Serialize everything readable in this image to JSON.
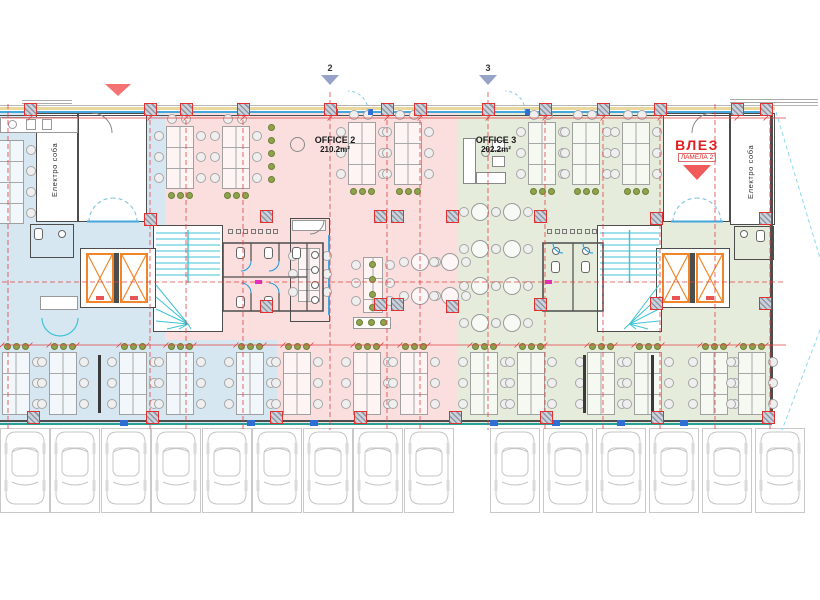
{
  "labels": {
    "office2": {
      "name": "OFFICE 2",
      "area": "210.2m²"
    },
    "office3": {
      "name": "OFFICE 3",
      "area": "202.2m²"
    },
    "entrance": {
      "title": "ВЛЕЗ",
      "subtitle": "ЛАМЕЛА 2"
    },
    "electro_left": "Електро соба",
    "electro_right": "Електро соба",
    "section2": "2",
    "section3": "3"
  },
  "colors": {
    "zone_blue": "#d7e7f1",
    "zone_pink": "#fbdfdf",
    "zone_green": "#e5ecdb",
    "grid_red": "#e04343",
    "wall": "#4d4d4d",
    "glass_blue": "#45a5dd",
    "facade_tan": "#e8d79e",
    "bottom_teal": "#2aa198",
    "stair_cyan": "#3ec3d4",
    "elevator_orange": "#f0862c",
    "plant_green": "#8fa24d",
    "car_gray": "#c6c6c6",
    "entrance_red": "#e02020",
    "marker_blue": "#97a3c6",
    "window_tick_blue": "#2f6fd4",
    "door_blue": "#7fc4e8",
    "magenta_tag": "#e22ecc"
  },
  "floor": {
    "zones": [
      {
        "color": "blue",
        "x": 0,
        "y": 112,
        "w": 165,
        "h": 228
      },
      {
        "color": "pink",
        "x": 165,
        "y": 112,
        "w": 293,
        "h": 228
      },
      {
        "color": "green",
        "x": 458,
        "y": 112,
        "w": 314,
        "h": 228
      },
      {
        "color": "blue",
        "x": 0,
        "y": 340,
        "w": 277,
        "h": 83
      },
      {
        "color": "pink",
        "x": 277,
        "y": 340,
        "w": 181,
        "h": 83
      },
      {
        "color": "green",
        "x": 458,
        "y": 340,
        "w": 314,
        "h": 83
      }
    ],
    "rooms": [
      {
        "name": "electro-room-left",
        "x": 36,
        "y": 113,
        "w": 42,
        "h": 109
      },
      {
        "name": "lobby-left",
        "x": 78,
        "y": 113,
        "w": 69,
        "h": 109
      },
      {
        "name": "stairwell-left",
        "x": 153,
        "y": 225,
        "w": 70,
        "h": 107
      },
      {
        "name": "elevator-shaft-left",
        "x": 80,
        "y": 248,
        "w": 76,
        "h": 60
      },
      {
        "name": "stairwell-right",
        "x": 597,
        "y": 225,
        "w": 65,
        "h": 107
      },
      {
        "name": "elevator-shaft-right",
        "x": 656,
        "y": 248,
        "w": 74,
        "h": 60
      },
      {
        "name": "lobby-right",
        "x": 663,
        "y": 113,
        "w": 67,
        "h": 109
      },
      {
        "name": "electro-room-right",
        "x": 730,
        "y": 113,
        "w": 45,
        "h": 112
      }
    ],
    "grid_x": [
      8,
      150,
      186,
      243,
      330,
      387,
      420,
      488,
      545,
      603,
      660,
      715,
      770
    ],
    "grid_y_dashed": [
      282
    ],
    "dim_y": [
      118,
      345
    ],
    "columns_top_x": [
      30,
      150,
      186,
      243,
      330,
      387,
      420,
      488,
      545,
      603,
      660,
      737,
      766
    ],
    "columns_bottom_x": [
      33,
      152,
      276,
      360,
      455,
      546,
      657,
      768
    ],
    "columns_interior": [
      [
        150,
        219
      ],
      [
        266,
        216
      ],
      [
        266,
        306
      ],
      [
        380,
        216
      ],
      [
        397,
        216
      ],
      [
        380,
        304
      ],
      [
        397,
        304
      ],
      [
        452,
        216
      ],
      [
        452,
        306
      ],
      [
        540,
        216
      ],
      [
        540,
        304
      ],
      [
        656,
        218
      ],
      [
        656,
        303
      ],
      [
        765,
        218
      ],
      [
        765,
        303
      ]
    ],
    "desk_columns_top": [
      {
        "x": 166,
        "y": 126
      },
      {
        "x": 222,
        "y": 126
      },
      {
        "x": 348,
        "y": 122
      },
      {
        "x": 394,
        "y": 122
      },
      {
        "x": 528,
        "y": 122
      },
      {
        "x": 572,
        "y": 122
      },
      {
        "x": 622,
        "y": 122
      }
    ],
    "desk_columns_bottom_x": [
      2,
      49,
      119,
      166,
      236,
      283,
      353,
      400,
      470,
      517,
      587,
      634,
      700,
      738
    ],
    "desk_bottom_y": 352,
    "partitions_x": [
      98,
      583,
      651
    ],
    "plant_strip": {
      "x": 268,
      "y": 124,
      "count": 5
    },
    "round_tables_pink": [
      [
        420,
        262
      ],
      [
        450,
        262
      ],
      [
        420,
        296
      ],
      [
        450,
        296
      ]
    ],
    "round_tables_green": [
      [
        480,
        212
      ],
      [
        512,
        212
      ],
      [
        480,
        249
      ],
      [
        512,
        249
      ],
      [
        480,
        286
      ],
      [
        512,
        286
      ],
      [
        480,
        323
      ],
      [
        512,
        323
      ]
    ],
    "parking_spots_x": [
      0,
      50,
      101,
      151,
      202,
      252,
      303,
      353,
      404,
      490,
      543,
      596,
      649,
      702,
      755
    ],
    "elevator_cells": [
      [
        86,
        253
      ],
      [
        120,
        253
      ],
      [
        662,
        253
      ],
      [
        696,
        253
      ]
    ],
    "stairs": [
      {
        "x": 153,
        "y": 225,
        "w": 70,
        "h": 107,
        "flip": false
      },
      {
        "x": 597,
        "y": 225,
        "w": 65,
        "h": 107,
        "flip": true
      }
    ],
    "window_ticks_x": [
      120,
      247,
      310,
      490,
      552,
      617,
      680
    ]
  }
}
